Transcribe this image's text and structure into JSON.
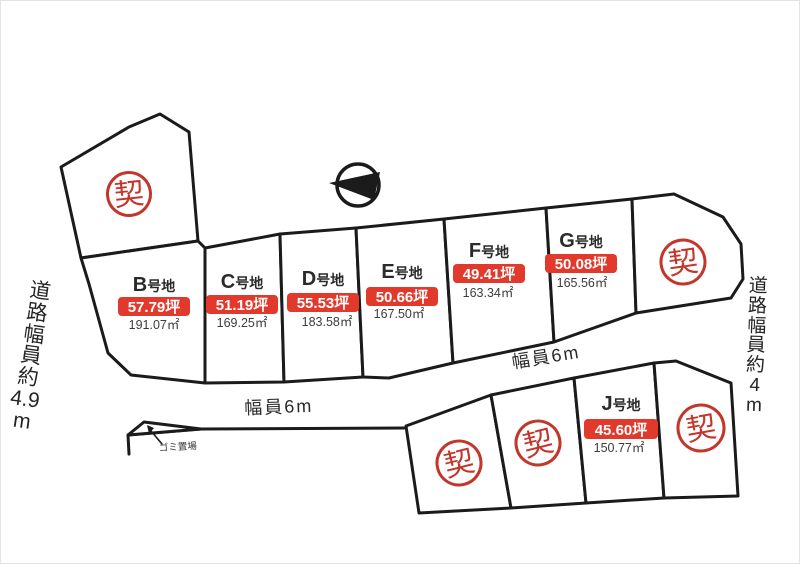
{
  "labels": {
    "road_left_vertical": "道路幅員約4.9m",
    "road_right_vertical": "道路幅員約4m",
    "road_width_upper": "幅員6m",
    "road_width_lower": "幅員6m",
    "garbage_area": "ゴミ置場",
    "sold_stamp": "契"
  },
  "plots": {
    "B": {
      "letter": "B",
      "suffix": "号地",
      "tsubo": "57.79坪",
      "area": "191.07㎡"
    },
    "C": {
      "letter": "C",
      "suffix": "号地",
      "tsubo": "51.19坪",
      "area": "169.25㎡"
    },
    "D": {
      "letter": "D",
      "suffix": "号地",
      "tsubo": "55.53坪",
      "area": "183.58㎡"
    },
    "E": {
      "letter": "E",
      "suffix": "号地",
      "tsubo": "50.66坪",
      "area": "167.50㎡"
    },
    "F": {
      "letter": "F",
      "suffix": "号地",
      "tsubo": "49.41坪",
      "area": "163.34㎡"
    },
    "G": {
      "letter": "G",
      "suffix": "号地",
      "tsubo": "50.08坪",
      "area": "165.56㎡"
    },
    "J": {
      "letter": "J",
      "suffix": "号地",
      "tsubo": "45.60坪",
      "area": "150.77㎡"
    }
  },
  "sold_plot_ids": [
    "A",
    "H",
    "I1",
    "I2",
    "K"
  ],
  "colors": {
    "line": "#1b1b1b",
    "badge_red": "#e13a2c",
    "stamp_red": "#c2362c",
    "text_dark": "#2b2b2b"
  }
}
